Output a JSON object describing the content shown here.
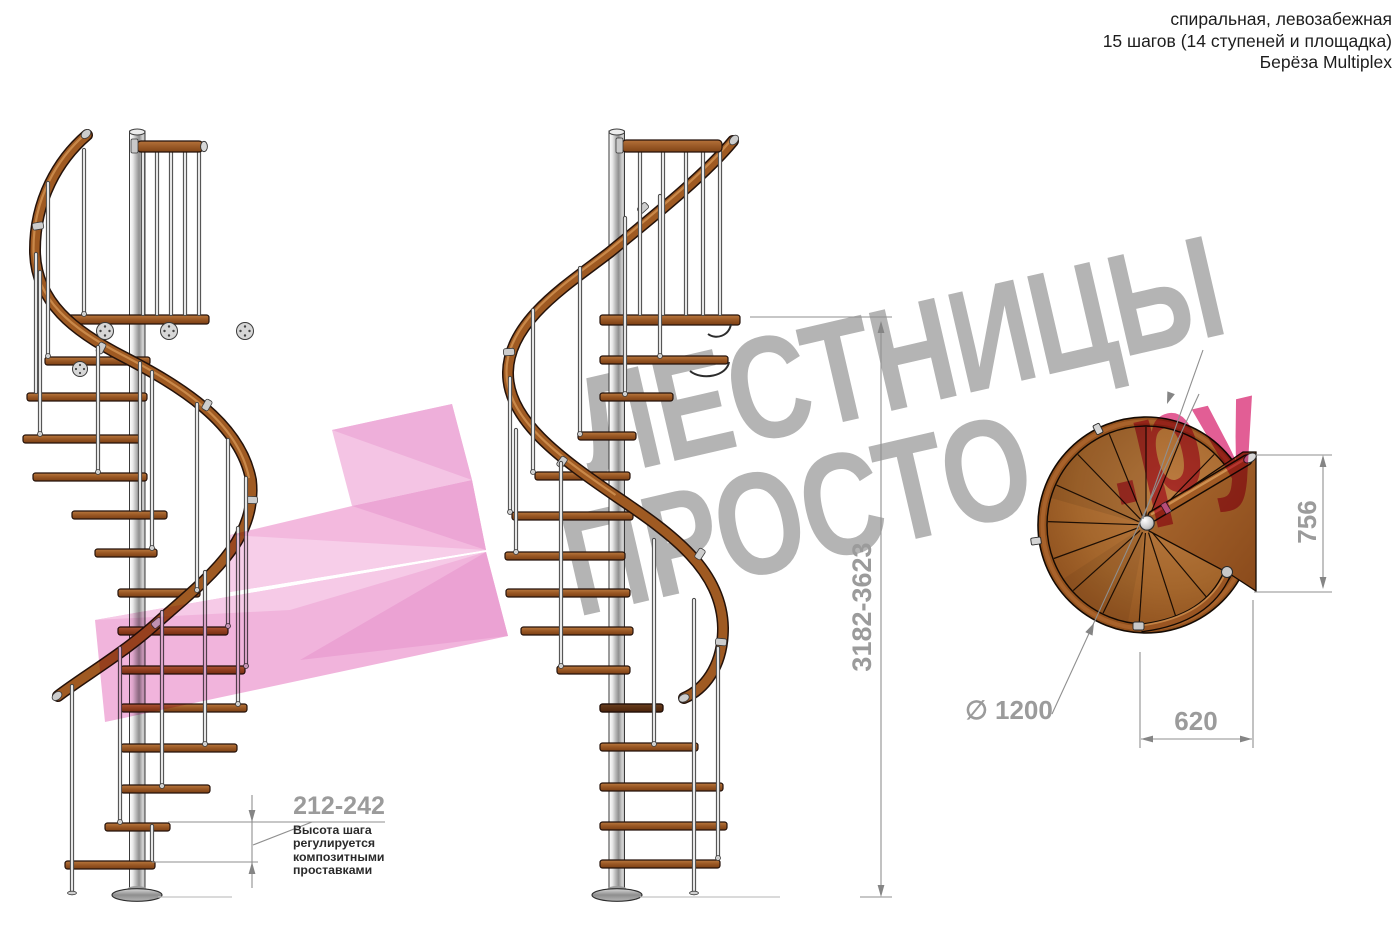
{
  "header": {
    "line1": "спиральная, левозабежная",
    "line2": "15 шагов (14 ступеней и площадка)",
    "line3": "Берёза Multiplex"
  },
  "watermark": {
    "brand_top": "ЛЕСТНИЦЫ",
    "brand_bottom": "ПРОСТО",
    "brand_suffix": ".ру",
    "gray_color": "#b4b4b4",
    "pink_color": "#e0528d",
    "logo_pink": "#f4c0e2"
  },
  "dimensions": {
    "total_height": "3182-3623",
    "step_height": "212-242",
    "step_height_note": "Высота шага\nрегулируется\nкомпозитными\nпроставками",
    "landing_depth": "756",
    "landing_width": "620",
    "diameter_symbol": "∅",
    "diameter_value": "1200"
  },
  "drawing": {
    "wood_color": "#9c5a26",
    "metal_color": "#c9c9c9",
    "views": [
      "left-elevation",
      "center-elevation",
      "plan-view"
    ]
  }
}
